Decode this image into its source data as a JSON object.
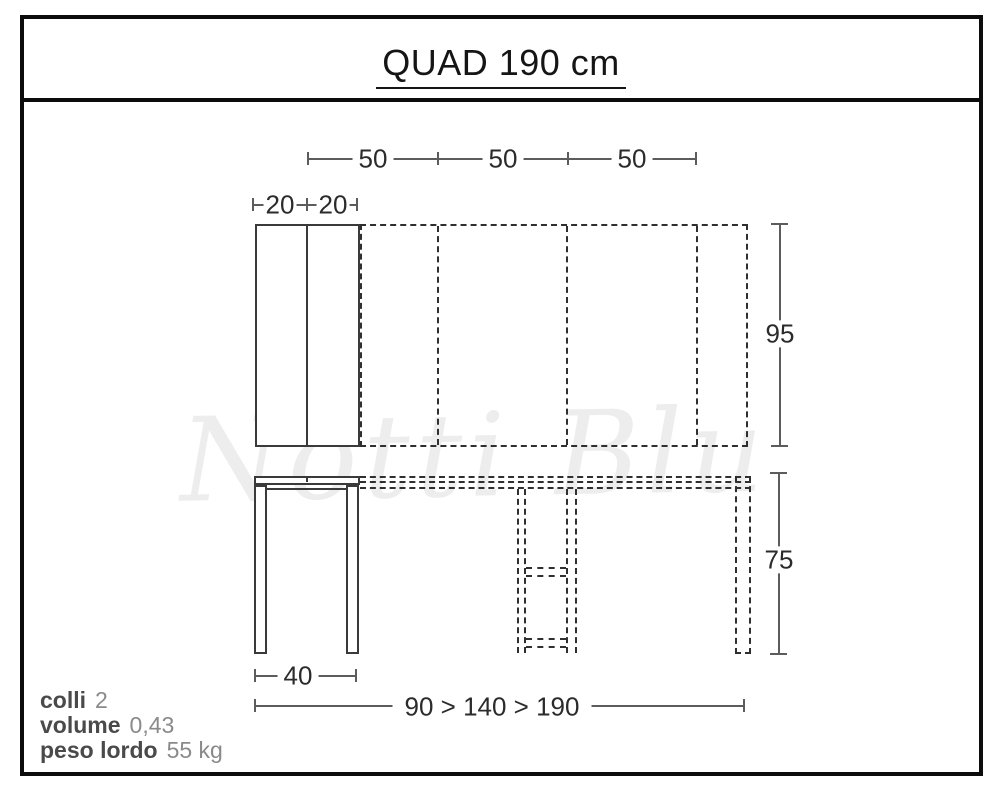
{
  "title": "QUAD 190 cm",
  "watermark": "Notti Blu",
  "colors": {
    "frame": "#0c0c0c",
    "line": "#3a3a3a",
    "dash": "#2f2f2f",
    "dimension": "#5c5c5c",
    "label_text": "#2b2b2b",
    "info_label": "#4a4a4a",
    "info_value": "#8a8a8a",
    "watermark": "#ededed"
  },
  "top_view": {
    "leaf_widths": [
      "50",
      "50",
      "50"
    ],
    "fold_widths": [
      "20",
      "20"
    ],
    "depth": "95"
  },
  "front_view": {
    "height": "75",
    "base_depth": "40",
    "width_extension": "90 > 140 > 190"
  },
  "info": [
    {
      "label": "colli",
      "value": "2"
    },
    {
      "label": "volume",
      "value": "0,43"
    },
    {
      "label": "peso lordo",
      "value": "55 kg"
    }
  ]
}
